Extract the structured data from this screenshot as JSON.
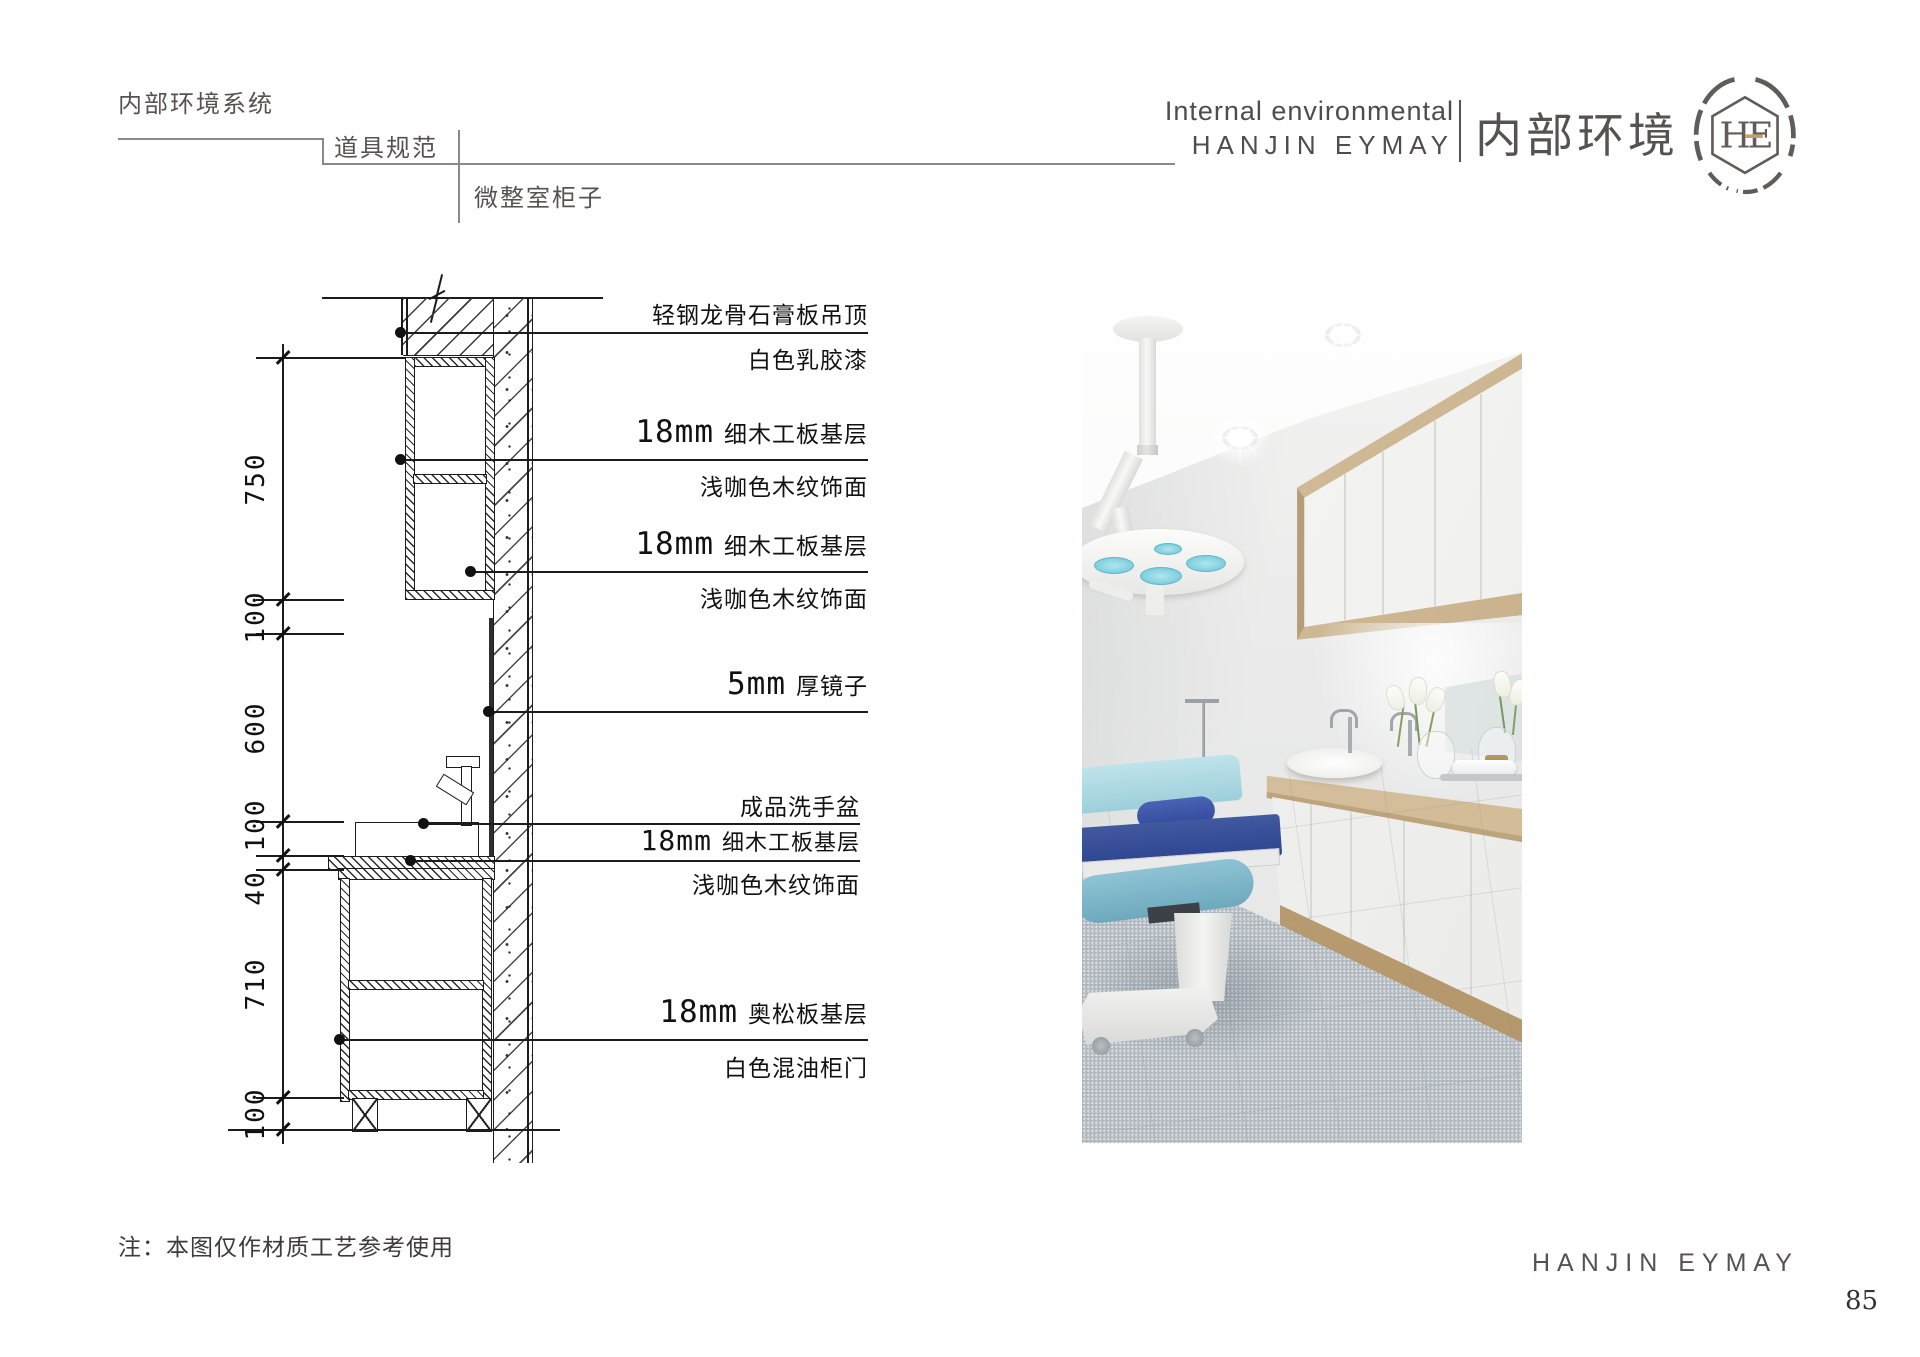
{
  "header": {
    "nav_level1": "内部环境系统",
    "nav_level2": "道具规范",
    "nav_level3": "微整室柜子",
    "brand_line1": "Internal environmental",
    "brand_line2": "HANJIN EYMAY",
    "brand_cn": "内部环境",
    "logo_monogram": "HE"
  },
  "drawing": {
    "dims": [
      "750",
      "100",
      "600",
      "100",
      "40",
      "710",
      "100"
    ],
    "ann": {
      "b1": {
        "above": "轻钢龙骨石膏板吊顶",
        "below": "白色乳胶漆"
      },
      "b2": {
        "mm": "18mm",
        "above": "细木工板基层",
        "below": "浅咖色木纹饰面"
      },
      "b3": {
        "mm": "18mm",
        "above": "细木工板基层",
        "below": "浅咖色木纹饰面"
      },
      "b4": {
        "mm": "5mm",
        "above": "厚镜子"
      },
      "b5": {
        "above": "成品洗手盆",
        "mm": "18mm",
        "mid": "细木工板基层",
        "below": "浅咖色木纹饰面"
      },
      "b6": {
        "mm": "18mm",
        "above": "奥松板基层",
        "below": "白色混油柜门"
      }
    }
  },
  "footer": {
    "note": "注：本图仅作材质工艺参考使用",
    "brand": "HANJIN EYMAY",
    "page_number": "85"
  },
  "colors": {
    "line": "#1c1c1c",
    "brand_gray": "#575252",
    "logo_gold": "#c9a063",
    "wood": "#cdb38c",
    "cabinet_white": "#f2f2f0",
    "bed_blue": "#3c55a0",
    "bed_teal": "#7fb6c9",
    "lamp_cyan": "#8fd8e4",
    "carpet_gray": "#b7bec4"
  }
}
